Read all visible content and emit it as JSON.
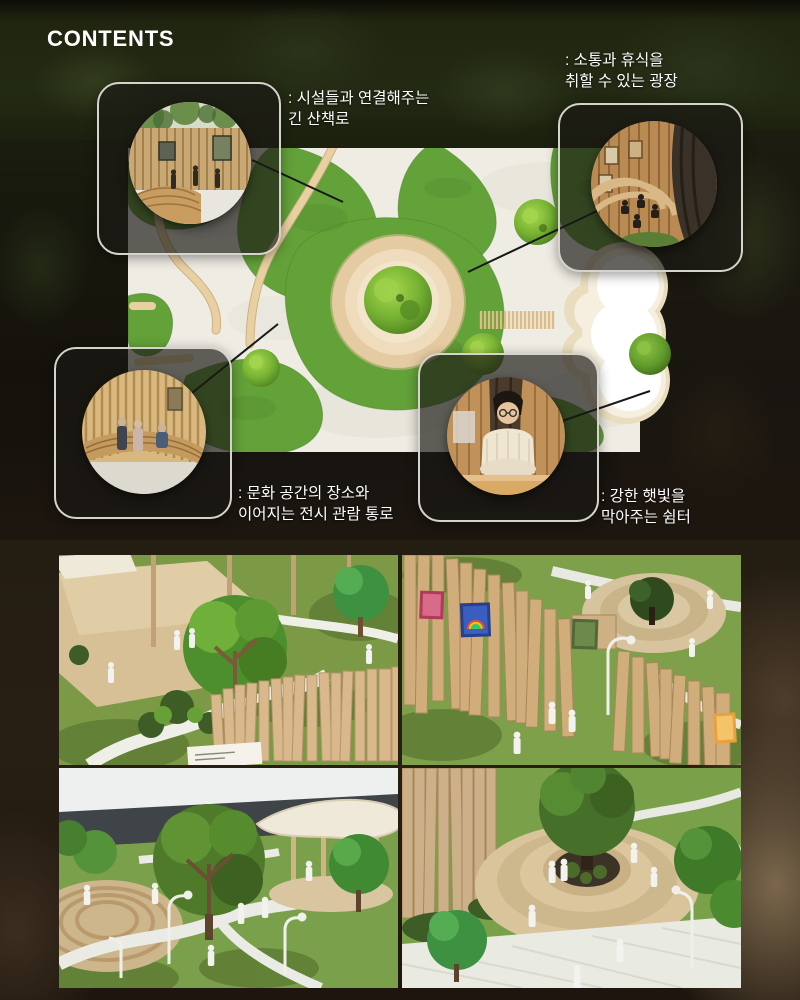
{
  "page": {
    "title": "CONTENTS",
    "background_color": "#171410",
    "text_color": "#ffffff"
  },
  "callouts": [
    {
      "id": "long-walkway",
      "label_line1": ": 시설들과 연결해주는",
      "label_line2": "긴 산책로"
    },
    {
      "id": "rest-plaza",
      "label_line1": ": 소통과 휴식을",
      "label_line2": "취할 수 있는 광장"
    },
    {
      "id": "exhibit-corridor",
      "label_line1": ": 문화 공간의 장소와",
      "label_line2": "이어지는 전시 관람 통로"
    },
    {
      "id": "sun-shelter",
      "label_line1": ": 강한 햇빛을",
      "label_line2": "막아주는 쉼터"
    }
  ],
  "colors": {
    "grass_green": "#63a139",
    "gravel_white": "#efece4",
    "path_tan": "#e9d0a2",
    "plaza_cream": "#f3e5cb",
    "wood": "#c9a873",
    "frame_border": "#d6d3cd",
    "connector_line": "#181818"
  }
}
